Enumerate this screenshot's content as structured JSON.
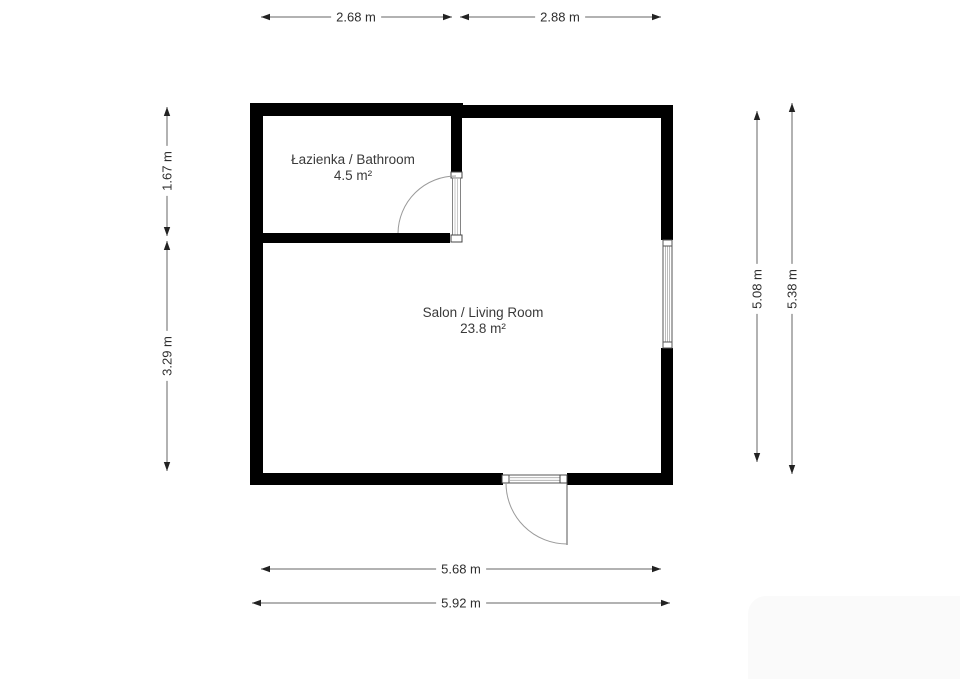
{
  "plan": {
    "rooms": [
      {
        "name": "Łazienka / Bathroom",
        "area": "4.5 m²"
      },
      {
        "name": "Salon / Living Room",
        "area": "23.8 m²"
      }
    ],
    "dimensions": {
      "top": [
        "2.68 m",
        "2.88 m"
      ],
      "left": [
        "1.67 m",
        "3.29 m"
      ],
      "right": [
        "5.08 m",
        "5.38 m"
      ],
      "bottom": [
        "5.68 m",
        "5.92 m"
      ]
    },
    "colors": {
      "wall": "#000000",
      "text": "#2e2e2e",
      "dimension_line": "#666666",
      "arrowhead": "#222222",
      "thin_line": "#555555",
      "stripe_line": "#aaaaaa",
      "door_arc": "#9a9a9a",
      "watermark_bg": "#fafafa"
    }
  }
}
